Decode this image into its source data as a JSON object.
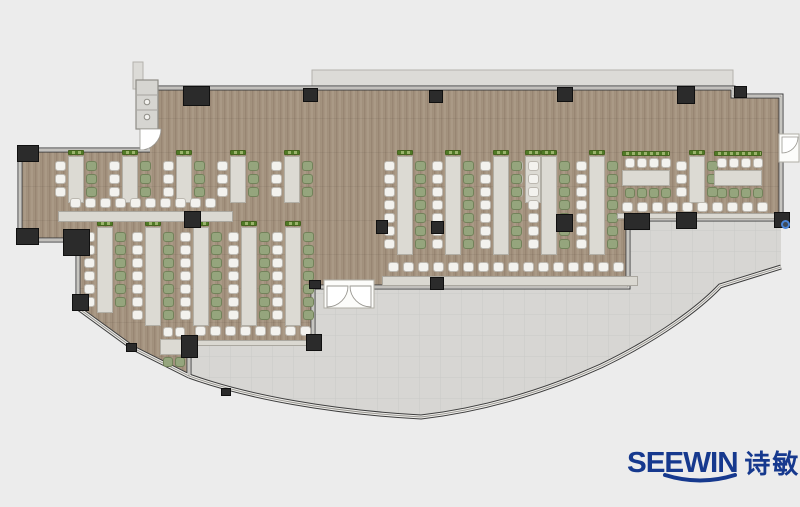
{
  "logo": {
    "brand": "SEEWIN",
    "cn": "诗敏"
  },
  "palette": {
    "bg": "#ececec",
    "wood": "#a59480",
    "terrace": "#d7d6d3",
    "wall": "#3d3d3d",
    "column": "#2b2b2b",
    "table": "#dcdad3",
    "table-border": "#b2afa6",
    "chair-white": "#f3f2ee",
    "chair-white-border": "#bcb8b0",
    "chair-green": "#95a57d",
    "chair-green-border": "#72825a",
    "plant-a": "#507a26",
    "plant-b": "#9ab36b",
    "bench": "#dad8d1",
    "ledge": "#dcdbd7",
    "door": "#fcfcfa",
    "brand": "#16398e"
  },
  "plan": {
    "clusters": [
      {
        "t": "v",
        "x": 55,
        "y": 150,
        "seats": 3,
        "left": "white",
        "right": "green",
        "plants": true
      },
      {
        "t": "v",
        "x": 109,
        "y": 150,
        "seats": 3,
        "left": "white",
        "right": "green",
        "plants": true
      },
      {
        "t": "v",
        "x": 163,
        "y": 150,
        "seats": 3,
        "left": "white",
        "right": "green",
        "plants": true
      },
      {
        "t": "v",
        "x": 217,
        "y": 150,
        "seats": 3,
        "left": "white",
        "right": "green",
        "plants": true
      },
      {
        "t": "v",
        "x": 271,
        "y": 150,
        "seats": 3,
        "left": "white",
        "right": "green",
        "plants": true
      },
      {
        "t": "v",
        "x": 512,
        "y": 150,
        "seats": 3,
        "left": "white",
        "right": "green",
        "plants": true
      },
      {
        "t": "v",
        "x": 384,
        "y": 150,
        "seats": 7,
        "left": "white",
        "right": "green",
        "plants": true
      },
      {
        "t": "v",
        "x": 432,
        "y": 150,
        "seats": 7,
        "left": "white",
        "right": "green",
        "plants": true
      },
      {
        "t": "v",
        "x": 480,
        "y": 150,
        "seats": 7,
        "left": "white",
        "right": "green",
        "plants": true
      },
      {
        "t": "v",
        "x": 528,
        "y": 150,
        "seats": 7,
        "left": "white",
        "right": "green",
        "plants": true
      },
      {
        "t": "v",
        "x": 576,
        "y": 150,
        "seats": 7,
        "left": "white",
        "right": "green",
        "plants": true
      },
      {
        "t": "v",
        "x": 84,
        "y": 221,
        "seats": 6,
        "left": "white",
        "right": "green",
        "plants": true
      },
      {
        "t": "v",
        "x": 132,
        "y": 221,
        "seats": 7,
        "left": "white",
        "right": "green",
        "plants": true
      },
      {
        "t": "v",
        "x": 180,
        "y": 221,
        "seats": 7,
        "left": "white",
        "right": "green",
        "plants": true
      },
      {
        "t": "v",
        "x": 228,
        "y": 221,
        "seats": 7,
        "left": "white",
        "right": "green",
        "plants": true
      },
      {
        "t": "v",
        "x": 272,
        "y": 221,
        "seats": 7,
        "left": "white",
        "right": "green",
        "plants": true
      },
      {
        "t": "v",
        "x": 676,
        "y": 150,
        "seats": 3,
        "left": "white",
        "right": "green",
        "plants": true
      },
      {
        "t": "h",
        "x": 622,
        "y": 151,
        "len": 48,
        "seats": 4,
        "top": "white",
        "bottom": "green",
        "plants": true
      },
      {
        "t": "h",
        "x": 714,
        "y": 151,
        "len": 48,
        "seats": 4,
        "top": "white",
        "bottom": "green",
        "plants": true
      },
      {
        "t": "h",
        "x": 160,
        "y": 327,
        "len": 28,
        "seats": 2,
        "top": "white",
        "bottom": "green",
        "plants": false
      }
    ],
    "benches": [
      {
        "chairs": {
          "x": 70,
          "y": 198,
          "len": 158
        },
        "strip": {
          "x": 58,
          "y": 211,
          "w": 175,
          "h": 11
        }
      },
      {
        "chairs": {
          "x": 195,
          "y": 326,
          "len": 118
        },
        "strip": {
          "x": 188,
          "y": 340,
          "w": 126,
          "h": 6
        }
      },
      {
        "chairs": {
          "x": 388,
          "y": 262,
          "len": 246
        },
        "strip": {
          "x": 382,
          "y": 276,
          "w": 256,
          "h": 10
        }
      },
      {
        "chairs": {
          "x": 622,
          "y": 202,
          "len": 150
        },
        "strip": {
          "x": 617,
          "y": 213,
          "w": 162,
          "h": 6
        }
      }
    ],
    "columns": [
      {
        "x": 183,
        "y": 86,
        "w": 27,
        "h": 20
      },
      {
        "x": 303,
        "y": 88,
        "w": 15,
        "h": 14
      },
      {
        "x": 429,
        "y": 90,
        "w": 14,
        "h": 13
      },
      {
        "x": 557,
        "y": 87,
        "w": 16,
        "h": 15
      },
      {
        "x": 677,
        "y": 86,
        "w": 18,
        "h": 18
      },
      {
        "x": 734,
        "y": 86,
        "w": 13,
        "h": 12
      },
      {
        "x": 17,
        "y": 145,
        "w": 22,
        "h": 17
      },
      {
        "x": 16,
        "y": 228,
        "w": 23,
        "h": 17
      },
      {
        "x": 63,
        "y": 229,
        "w": 27,
        "h": 27
      },
      {
        "x": 72,
        "y": 294,
        "w": 17,
        "h": 17
      },
      {
        "x": 184,
        "y": 211,
        "w": 17,
        "h": 17
      },
      {
        "x": 376,
        "y": 220,
        "w": 12,
        "h": 14
      },
      {
        "x": 431,
        "y": 221,
        "w": 13,
        "h": 13
      },
      {
        "x": 556,
        "y": 214,
        "w": 17,
        "h": 18
      },
      {
        "x": 624,
        "y": 213,
        "w": 26,
        "h": 17
      },
      {
        "x": 676,
        "y": 212,
        "w": 21,
        "h": 17
      },
      {
        "x": 774,
        "y": 212,
        "w": 16,
        "h": 16
      },
      {
        "x": 181,
        "y": 335,
        "w": 17,
        "h": 23
      },
      {
        "x": 306,
        "y": 334,
        "w": 16,
        "h": 17
      },
      {
        "x": 309,
        "y": 280,
        "w": 12,
        "h": 9
      },
      {
        "x": 430,
        "y": 277,
        "w": 14,
        "h": 13
      },
      {
        "x": 126,
        "y": 343,
        "w": 11,
        "h": 9
      },
      {
        "x": 221,
        "y": 388,
        "w": 10,
        "h": 8
      }
    ],
    "marker": {
      "x": 781,
      "y": 220,
      "w": 9,
      "h": 9
    }
  }
}
